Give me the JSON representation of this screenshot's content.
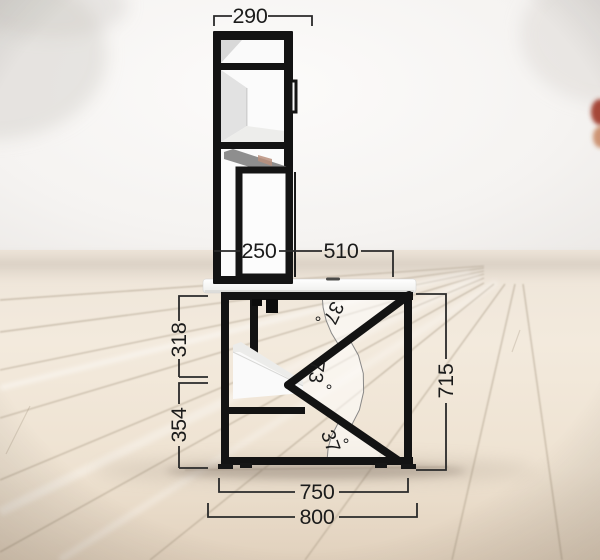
{
  "drawing_title": "desk-with-hutch-side-view",
  "dim_labels": {
    "hutch_width": "290",
    "shelf_box_width": "250",
    "desktop_span": "510",
    "upper_height": "318",
    "lower_height": "354",
    "frame_height": "715",
    "frame_width": "750",
    "tabletop_width": "800"
  },
  "angle_labels": {
    "top_value": "37",
    "mid_value": "73",
    "bottom_value": "37",
    "degree": "°"
  },
  "colors": {
    "frame_black": "#131313",
    "dimension_line": "#2a2a2a",
    "dimension_text": "#1b1b1b",
    "wedge_stroke": "#7d7d7d",
    "floor_seam": "#a3947f",
    "wall_light": "#f4f2f0",
    "floor_light": "#f1e7da"
  }
}
